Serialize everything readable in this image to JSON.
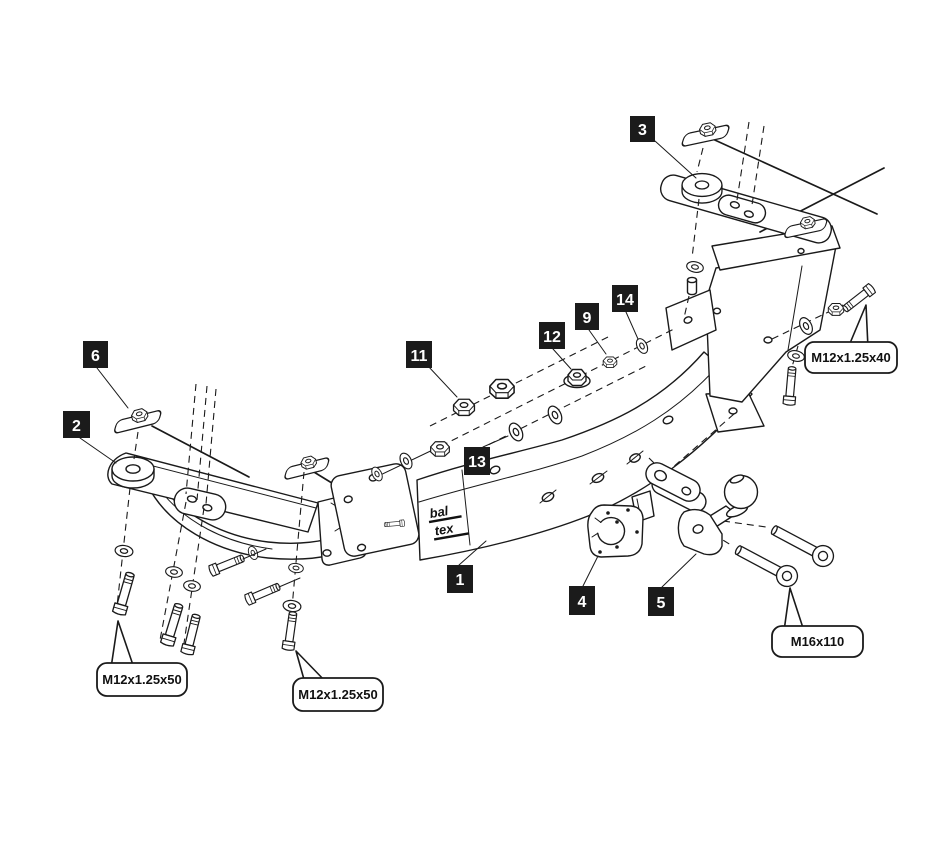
{
  "diagram": {
    "type": "exploded-assembly-drawing",
    "subject": "towbar hitch assembly",
    "background_color": "#ffffff",
    "line_color": "#1a1a1a",
    "label_box_color": "#1b1b1b",
    "label_text_color": "#ffffff",
    "logo": {
      "line1": "bal",
      "line2": "tex"
    },
    "part_labels": [
      {
        "num": "1"
      },
      {
        "num": "2"
      },
      {
        "num": "3"
      },
      {
        "num": "4"
      },
      {
        "num": "5"
      },
      {
        "num": "6"
      },
      {
        "num": "9"
      },
      {
        "num": "11"
      },
      {
        "num": "12"
      },
      {
        "num": "13"
      },
      {
        "num": "14"
      }
    ],
    "callouts": [
      {
        "text": "M12x1.25x40"
      },
      {
        "text": "M12x1.25x50"
      },
      {
        "text": "M12x1.25x50"
      },
      {
        "text": "M16x110"
      }
    ]
  }
}
